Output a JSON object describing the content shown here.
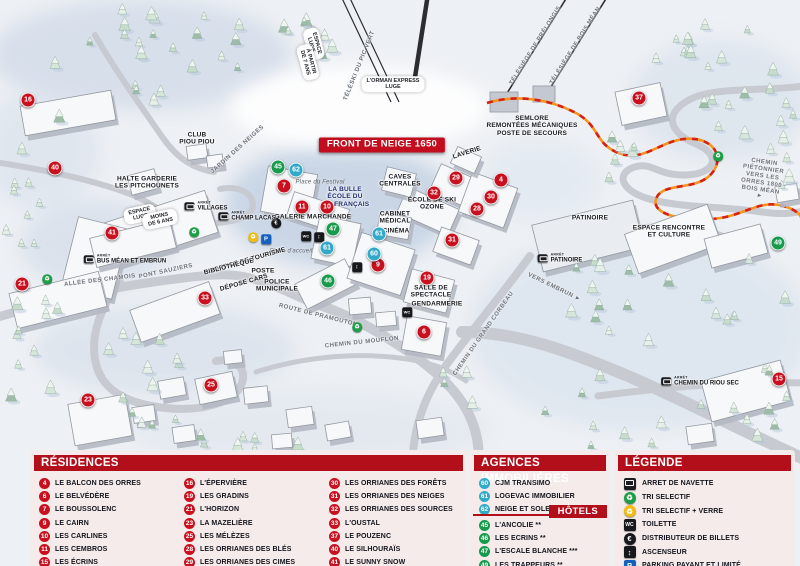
{
  "colors": {
    "residence": "#c8101f",
    "hotel": "#169a4b",
    "agence": "#33a9ca",
    "header": "#b30f1b"
  },
  "map": {
    "arret_label": "ARRÊT",
    "banner": "FRONT DE NEIGE 1650",
    "markers": [
      {
        "num": "16",
        "kind": "residence",
        "x": 28,
        "y": 100
      },
      {
        "num": "40",
        "kind": "residence",
        "x": 55,
        "y": 168
      },
      {
        "num": "41",
        "kind": "residence",
        "x": 112,
        "y": 233
      },
      {
        "num": "21",
        "kind": "residence",
        "x": 22,
        "y": 284
      },
      {
        "num": "33",
        "kind": "residence",
        "x": 205,
        "y": 298
      },
      {
        "num": "23",
        "kind": "residence",
        "x": 88,
        "y": 400
      },
      {
        "num": "25",
        "kind": "residence",
        "x": 211,
        "y": 385
      },
      {
        "num": "7",
        "kind": "residence",
        "x": 284,
        "y": 186
      },
      {
        "num": "11",
        "kind": "residence",
        "x": 302,
        "y": 207
      },
      {
        "num": "10",
        "kind": "residence",
        "x": 327,
        "y": 207
      },
      {
        "num": "29",
        "kind": "residence",
        "x": 456,
        "y": 178
      },
      {
        "num": "32",
        "kind": "residence",
        "x": 434,
        "y": 193
      },
      {
        "num": "4",
        "kind": "residence",
        "x": 501,
        "y": 180
      },
      {
        "num": "30",
        "kind": "residence",
        "x": 491,
        "y": 197
      },
      {
        "num": "28",
        "kind": "residence",
        "x": 477,
        "y": 209
      },
      {
        "num": "31",
        "kind": "residence",
        "x": 452,
        "y": 240
      },
      {
        "num": "9",
        "kind": "residence",
        "x": 378,
        "y": 265
      },
      {
        "num": "19",
        "kind": "residence",
        "x": 427,
        "y": 278
      },
      {
        "num": "6",
        "kind": "residence",
        "x": 424,
        "y": 332
      },
      {
        "num": "37",
        "kind": "residence",
        "x": 639,
        "y": 98
      },
      {
        "num": "15",
        "kind": "residence",
        "x": 779,
        "y": 379
      },
      {
        "num": "45",
        "kind": "hotel",
        "x": 278,
        "y": 167
      },
      {
        "num": "47",
        "kind": "hotel",
        "x": 333,
        "y": 229
      },
      {
        "num": "46",
        "kind": "hotel",
        "x": 328,
        "y": 281
      },
      {
        "num": "49",
        "kind": "hotel",
        "x": 778,
        "y": 243
      },
      {
        "num": "62",
        "kind": "agence",
        "x": 296,
        "y": 170
      },
      {
        "num": "61",
        "kind": "agence",
        "x": 327,
        "y": 248
      },
      {
        "num": "61",
        "kind": "agence",
        "x": 379,
        "y": 234
      },
      {
        "num": "60",
        "kind": "agence",
        "x": 374,
        "y": 254
      }
    ],
    "labels": [
      {
        "id": "front-de-neige-banner",
        "kind": "banner",
        "text": "FRONT DE NEIGE 1650",
        "x": 382,
        "y": 145
      },
      {
        "kind": "pill",
        "text": "L'ORMAN EXPRESS\nLUGE",
        "x": 393,
        "y": 84
      },
      {
        "kind": "pill",
        "text": "ESPACE\nLUGE",
        "x": 314,
        "y": 44,
        "rot": 75
      },
      {
        "kind": "pill",
        "text": "À PARTIR\nDE 7 ANS",
        "x": 308,
        "y": 62,
        "rot": 75
      },
      {
        "kind": "road",
        "text": "TÉLÉSKI DU PIC VERT",
        "x": 360,
        "y": 66,
        "rot": -68
      },
      {
        "kind": "road",
        "text": "TÉLÉSIÈGE DE PRÉLONGIS",
        "x": 536,
        "y": 46,
        "rot": -58
      },
      {
        "kind": "road",
        "text": "TÉLÉSIÈGE DE BOIS MÉAN",
        "x": 576,
        "y": 46,
        "rot": -58
      },
      {
        "kind": "pill",
        "text": "ESPACE\nLUGE",
        "x": 140,
        "y": 214,
        "rot": -12
      },
      {
        "kind": "pill",
        "text": "MOINS\nDE 6 ANS",
        "x": 160,
        "y": 219,
        "rot": -12
      },
      {
        "kind": "place",
        "text": "HALTE GARDERIE\nLES PITCHOUNETS",
        "x": 147,
        "y": 183
      },
      {
        "kind": "place",
        "text": "CLUB\nPIOU PIOU",
        "x": 197,
        "y": 139
      },
      {
        "kind": "road",
        "text": "JARDIN DES NEIGES",
        "x": 238,
        "y": 150,
        "rot": -42
      },
      {
        "kind": "place-blue",
        "text": "LA BULLE\nÉCOLE DU\nSKI FRANÇAIS",
        "x": 345,
        "y": 197
      },
      {
        "kind": "italic",
        "text": "Place du Festival",
        "x": 320,
        "y": 183
      },
      {
        "kind": "place",
        "text": "GALERIE MARCHANDE",
        "x": 313,
        "y": 217
      },
      {
        "kind": "place",
        "text": "CAVES\nCENTRALES",
        "x": 400,
        "y": 181
      },
      {
        "kind": "place",
        "text": "LAVERIE",
        "x": 467,
        "y": 153,
        "rot": -18
      },
      {
        "kind": "place",
        "text": "ÉCOLE DE SKI\nOZONE",
        "x": 432,
        "y": 204
      },
      {
        "kind": "place",
        "text": "CABINET\nMÉDICAL",
        "x": 395,
        "y": 218
      },
      {
        "kind": "place",
        "text": "CINÉMA",
        "x": 396,
        "y": 231
      },
      {
        "kind": "italic",
        "text": "Place d'accueil",
        "x": 291,
        "y": 252
      },
      {
        "kind": "place",
        "text": "OFFICE DE TOURISME",
        "x": 250,
        "y": 260,
        "rot": -16
      },
      {
        "kind": "place",
        "text": "BIBLIOTHÈQUE",
        "x": 229,
        "y": 267,
        "rot": -14
      },
      {
        "kind": "place",
        "text": "POSTE",
        "x": 263,
        "y": 271
      },
      {
        "kind": "place",
        "text": "DÉPOSE CARS",
        "x": 244,
        "y": 283,
        "rot": -16
      },
      {
        "kind": "place",
        "text": "POLICE\nMUNICIPALE",
        "x": 277,
        "y": 286
      },
      {
        "kind": "place",
        "text": "SALLE DE\nSPECTACLE",
        "x": 431,
        "y": 292
      },
      {
        "kind": "place",
        "text": "GENDARMERIE",
        "x": 437,
        "y": 304
      },
      {
        "kind": "place",
        "text": "SEMLORE\nREMONTÉES MÉCANIQUES\nPOSTE DE SECOURS",
        "x": 532,
        "y": 126
      },
      {
        "kind": "place",
        "text": "PATINOIRE",
        "x": 590,
        "y": 218
      },
      {
        "kind": "place",
        "text": "ESPACE RENCONTRE\nET CULTURE",
        "x": 669,
        "y": 232
      },
      {
        "kind": "road",
        "text": "ALLÉE DES CHAMOIS",
        "x": 100,
        "y": 281,
        "rot": -7
      },
      {
        "kind": "road",
        "text": "PONT SAUZIERS",
        "x": 166,
        "y": 272,
        "rot": -12
      },
      {
        "kind": "road",
        "text": "ROUTE DE PRAMOUTON",
        "x": 318,
        "y": 316,
        "rot": 14
      },
      {
        "kind": "road",
        "text": "CHEMIN DU MOUFLON",
        "x": 362,
        "y": 343,
        "rot": -6
      },
      {
        "kind": "road",
        "text": "CHEMIN DU GRAND CORBEAU",
        "x": 484,
        "y": 334,
        "rot": -55
      },
      {
        "kind": "road",
        "text": "VERS EMBRUN ►",
        "x": 554,
        "y": 288,
        "rot": 26
      },
      {
        "kind": "road",
        "text": "CHEMIN PIÉTONNIER\nVERS LES ORRES 1800\nBOIS MÉAN ►",
        "x": 762,
        "y": 180,
        "rot": 8
      }
    ],
    "bus_stops": [
      {
        "name": "VILLAGES",
        "x": 206,
        "y": 206
      },
      {
        "name": "CHAMP LACAS",
        "x": 247,
        "y": 216
      },
      {
        "name": "BUS MÉAN ET EMBRUN",
        "x": 125,
        "y": 259
      },
      {
        "name": "PATINOIRE",
        "x": 560,
        "y": 258
      },
      {
        "name": "CHEMIN DU RIOU SEC",
        "x": 700,
        "y": 381
      }
    ],
    "icons": [
      {
        "type": "recycle",
        "x": 194,
        "y": 232
      },
      {
        "type": "recycle",
        "x": 47,
        "y": 279
      },
      {
        "type": "recycle",
        "x": 357,
        "y": 327
      },
      {
        "type": "recycle",
        "x": 718,
        "y": 156
      },
      {
        "type": "recycle-glass",
        "x": 253,
        "y": 237
      },
      {
        "type": "parking",
        "x": 266,
        "y": 239
      },
      {
        "type": "atm",
        "x": 276,
        "y": 223
      },
      {
        "type": "toilet",
        "x": 306,
        "y": 236
      },
      {
        "type": "toilet",
        "x": 407,
        "y": 312
      },
      {
        "type": "elevator",
        "x": 319,
        "y": 237
      },
      {
        "type": "elevator",
        "x": 357,
        "y": 267
      }
    ]
  },
  "panel": {
    "residences": {
      "title": "RÉSIDENCES",
      "items": [
        {
          "num": "4",
          "label": "LE BALCON DES ORRES"
        },
        {
          "num": "6",
          "label": "LE BELVÉDÈRE"
        },
        {
          "num": "7",
          "label": "LE BOUSSOLENC"
        },
        {
          "num": "9",
          "label": "LE CAIRN"
        },
        {
          "num": "10",
          "label": "LES CARLINES"
        },
        {
          "num": "11",
          "label": "LES CEMBROS"
        },
        {
          "num": "15",
          "label": "LES ÉCRINS"
        },
        {
          "num": "16",
          "label": "L'ÉPERVIÈRE"
        },
        {
          "num": "19",
          "label": "LES GRADINS"
        },
        {
          "num": "21",
          "label": "L'HORIZON"
        },
        {
          "num": "23",
          "label": "LA MAZELIÈRE"
        },
        {
          "num": "25",
          "label": "LES MÉLÈZES"
        },
        {
          "num": "28",
          "label": "LES ORRIANES DES BLÉS"
        },
        {
          "num": "29",
          "label": "LES ORRIANES DES CIMES"
        },
        {
          "num": "30",
          "label": "LES ORRIANES DES FORÊTS"
        },
        {
          "num": "31",
          "label": "LES ORRIANES DES NEIGES"
        },
        {
          "num": "32",
          "label": "LES ORRIANES DES SOURCES"
        },
        {
          "num": "33",
          "label": "L'OUSTAL"
        },
        {
          "num": "37",
          "label": "LE POUZENC"
        },
        {
          "num": "40",
          "label": "LE SILHOURAÏS"
        },
        {
          "num": "41",
          "label": "LE SUNNY SNOW"
        }
      ]
    },
    "agences": {
      "title": "AGENCES IMMOBILIÈRES",
      "items": [
        {
          "num": "60",
          "label": "CJM TRANSIMO"
        },
        {
          "num": "61",
          "label": "LOGEVAC IMMOBILIER"
        },
        {
          "num": "62",
          "label": "NEIGE ET SOLEIL"
        }
      ]
    },
    "hotels": {
      "title": "HÔTELS",
      "items": [
        {
          "num": "45",
          "label": "L'ANCOLIE **"
        },
        {
          "num": "46",
          "label": "LES ECRINS **"
        },
        {
          "num": "47",
          "label": "L'ESCALE BLANCHE ***"
        },
        {
          "num": "49",
          "label": "LES TRAPPEURS **"
        }
      ]
    },
    "legende": {
      "title": "LÉGENDE",
      "items": [
        {
          "icon": "bus",
          "label": "ARRET DE NAVETTE"
        },
        {
          "icon": "recycle",
          "label": "TRI SELECTIF"
        },
        {
          "icon": "recycle-glass",
          "label": "TRI SELECTIF + VERRE"
        },
        {
          "icon": "toilet",
          "label": "TOILETTE"
        },
        {
          "icon": "atm",
          "label": "DISTRIBUTEUR DE BILLETS"
        },
        {
          "icon": "elevator",
          "label": "ASCENSEUR"
        },
        {
          "icon": "parking",
          "label": "PARKING PAYANT ET LIMITÉ"
        }
      ]
    }
  }
}
